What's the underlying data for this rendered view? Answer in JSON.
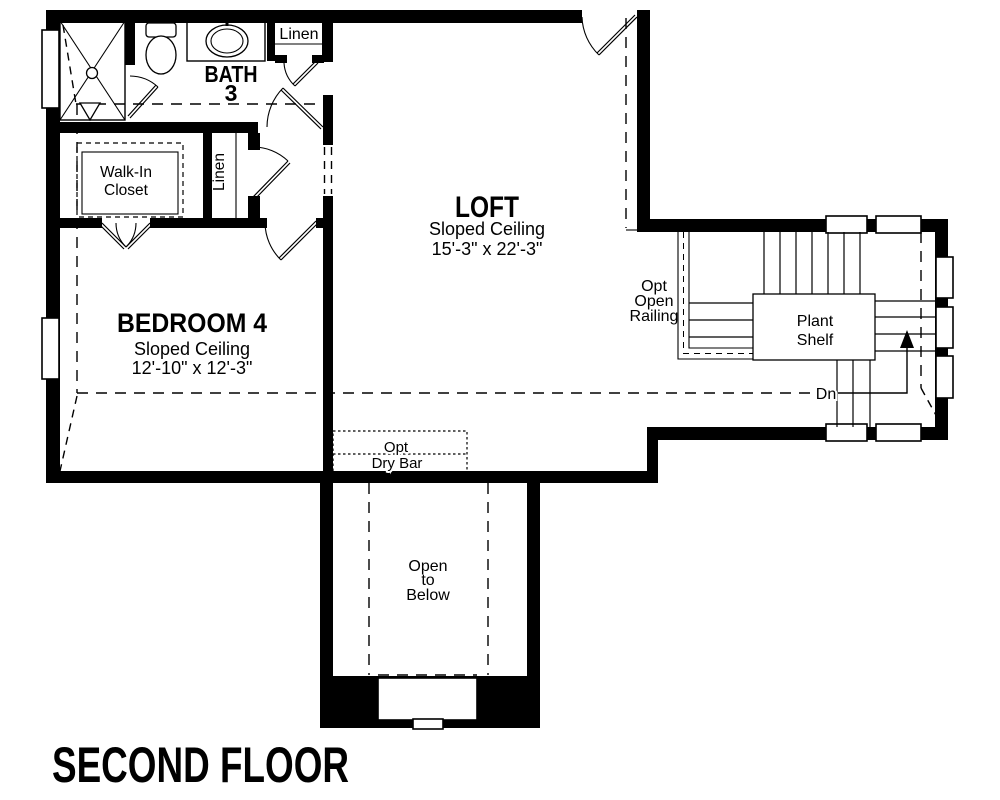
{
  "title": "SECOND FLOOR",
  "labels": {
    "bath": {
      "l1": "BATH",
      "l2": "3"
    },
    "linen_top": "Linen",
    "walk_in": {
      "l1": "Walk-In",
      "l2": "Closet"
    },
    "linen_hall": "Linen",
    "loft": {
      "name": "LOFT",
      "l2": "Sloped Ceiling",
      "l3": "15'-3\" x 22'-3\""
    },
    "bedroom": {
      "name": "BEDROOM 4",
      "l2": "Sloped Ceiling",
      "l3": "12'-10\" x 12'-3\""
    },
    "railing": {
      "l1": "Opt",
      "l2": "Open",
      "l3": "Railing"
    },
    "plant_shelf": {
      "l1": "Plant",
      "l2": "Shelf"
    },
    "stairs": {
      "down": "Dn"
    },
    "dry_bar": {
      "l1": "Opt",
      "l2": "Dry Bar"
    },
    "open_below": {
      "l1": "Open",
      "l2": "to",
      "l3": "Below"
    }
  },
  "colors": {
    "wall": "#000000",
    "background": "#ffffff"
  }
}
